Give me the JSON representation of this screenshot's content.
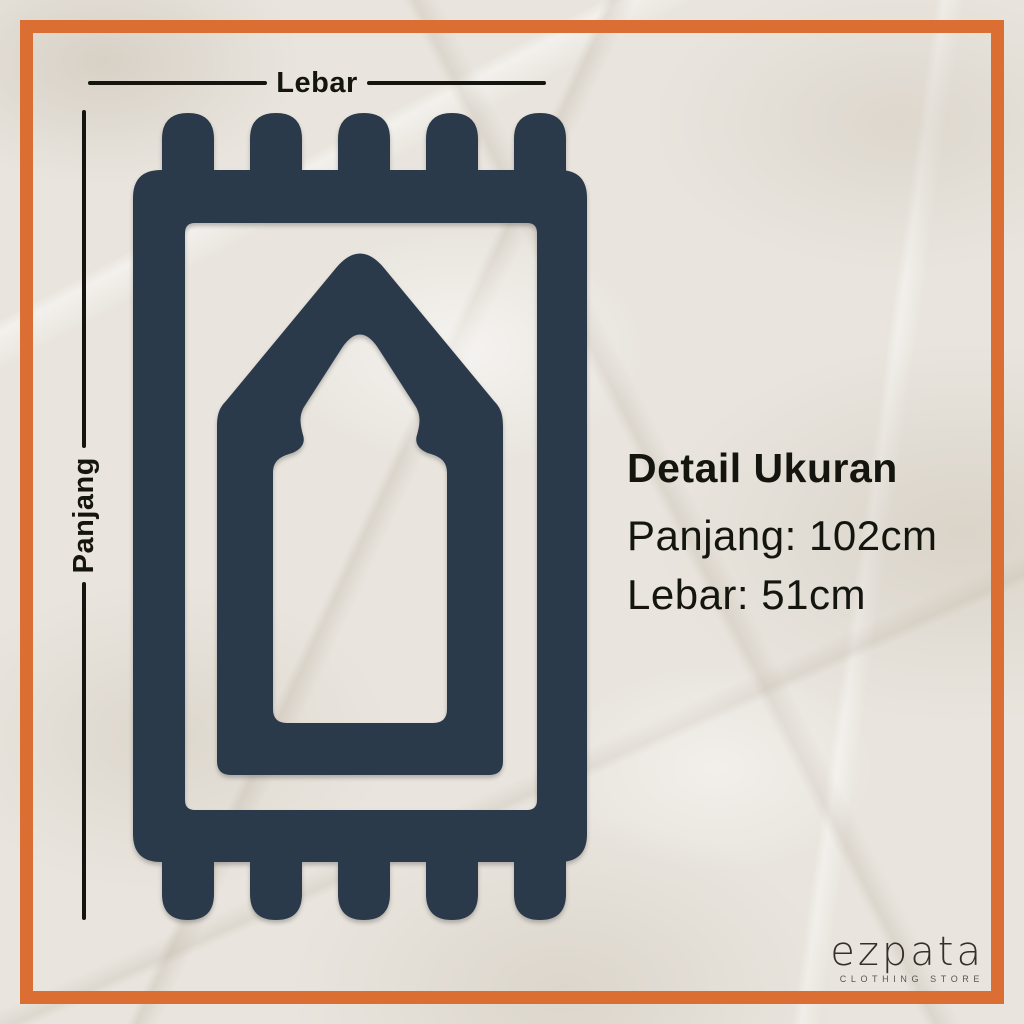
{
  "colors": {
    "frame_orange": "#db6e33",
    "mat_navy": "#2b3a4a",
    "paper_background": "#e9e5de",
    "text_black": "#15150f"
  },
  "measurements": {
    "width_label": "Lebar",
    "length_label": "Panjang"
  },
  "size_details": {
    "title": "Detail Ukuran",
    "length_line": "Panjang: 102cm",
    "width_line": "Lebar: 51cm"
  },
  "logo": {
    "brand": "ezpata",
    "tagline": "CLOTHING STORE"
  },
  "icons": {
    "prayer_mat": "prayer-mat-icon"
  }
}
